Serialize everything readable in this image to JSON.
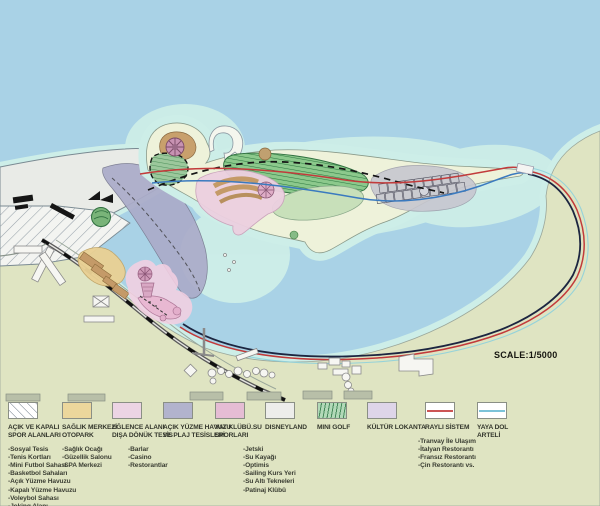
{
  "scale_label": "SCALE:1/5000",
  "colors": {
    "water": "#a9d2e6",
    "shallow_water": "#cdeee8",
    "land": "#dfe4c2",
    "land_pale": "#eef2da",
    "white_area": "#e9ebe7",
    "sports_hatch_bg": "#f3f4f1",
    "beach_corridor_lavender": "#abacc9",
    "entertainment_pink": "#ecd0e0",
    "marina_pink": "#e8b8d2",
    "marina_glow": "#f3cfe1",
    "health_orange": "#e9d094",
    "mini_golf_green": "#8cc98c",
    "park_green_light": "#c8e0ba",
    "grid_area_gray": "#c7c7d0",
    "rail_red": "#c23b3b",
    "pedestrian_blue": "#3a7abf",
    "loop_dark": "#1c2540",
    "coast_cyan_line": "#8ed0dc",
    "building_white": "#f6f6f2",
    "building_tan": "#c49a68",
    "tower_mauve": "#c792b2"
  },
  "legend": {
    "items": [
      {
        "title_lines": [
          "AÇIK VE KAPALI",
          "SPOR ALANLARI"
        ],
        "swatch": {
          "type": "hatch-diagonal",
          "fill": "#ffffff"
        },
        "items": [
          "-Sosyal Tesis",
          "-Tenis Kortları",
          "-Mini Futbol Sahası",
          "-Basketbol Sahaları",
          "-Açık Yüzme Havuzu",
          "-Kapalı Yüzme Havuzu",
          "-Voleybol Sahası",
          "-Joking Alanı"
        ]
      },
      {
        "title_lines": [
          "SAĞLIK MERKEZİ",
          "OTOPARK"
        ],
        "swatch": {
          "type": "solid",
          "fill": "#ecd79c"
        },
        "items": [
          "-Sağlık Ocağı",
          "-Güzellik Salonu",
          "-SPA Merkezi"
        ]
      },
      {
        "title_lines": [
          "EĞLENCE ALANI",
          "DIŞA DÖNÜK TESİS"
        ],
        "swatch": {
          "type": "solid",
          "fill": "#ecd4e4"
        },
        "items": [
          "-Barlar",
          "-Casino",
          "-Restorantlar"
        ]
      },
      {
        "title_lines": [
          "AÇIK YÜZME HAVUZU",
          "VE PLAJ TESİSLERİ"
        ],
        "swatch": {
          "type": "solid",
          "fill": "#b2b3cd"
        },
        "items": []
      },
      {
        "title_lines": [
          "YAT KLÜBÜ.SU",
          "SPORLARI"
        ],
        "swatch": {
          "type": "solid",
          "fill": "#e5bcd4"
        },
        "items": [
          "-Jetski",
          "-Su Kayağı",
          "-Optimis",
          "-Sailing Kurs Yeri",
          "-Su Altı Tekneleri",
          "-Patinaj Klübü"
        ]
      },
      {
        "title_lines": [
          "DISNEYLAND"
        ],
        "swatch": {
          "type": "solid",
          "fill": "#ededeb"
        },
        "items": []
      },
      {
        "title_lines": [
          "MINI GOLF"
        ],
        "swatch": {
          "type": "hatch-vertical",
          "fill": "#b2d9b8"
        },
        "items": []
      },
      {
        "title_lines": [
          "KÜLTÜR LOKANTA"
        ],
        "swatch": {
          "type": "solid",
          "fill": "#ded5e9"
        },
        "items": [
          "-Tranvay İle Ulaşım",
          "-İtalyan Restorantı",
          "-Fransız Restorantı",
          "-Çin Restorantı vs."
        ]
      },
      {
        "title_lines": [
          "RAYLI SİSTEM"
        ],
        "swatch": {
          "type": "line",
          "fill": "#ffffff",
          "line": "#cc5555"
        },
        "items": []
      },
      {
        "title_lines": [
          "YAYA DOL",
          "ARTELİ"
        ],
        "swatch": {
          "type": "line",
          "fill": "#ffffff",
          "line": "#7cc3d8"
        },
        "items": []
      }
    ]
  }
}
